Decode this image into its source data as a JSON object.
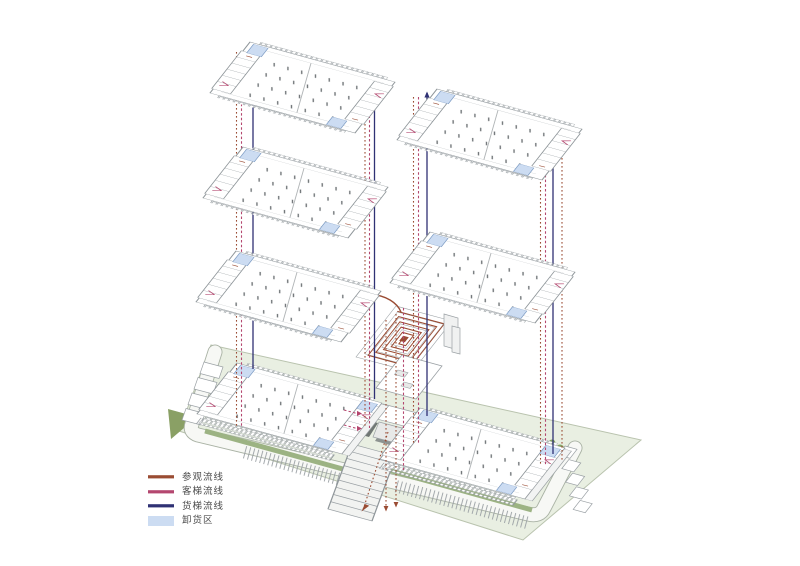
{
  "legend": {
    "items": [
      {
        "label": "参观流线",
        "color": "#9a4c33",
        "type": "line"
      },
      {
        "label": "客梯流线",
        "color": "#b4476f",
        "type": "line"
      },
      {
        "label": "货梯流线",
        "color": "#2f3174",
        "type": "line"
      },
      {
        "label": "卸货区",
        "color": "#ccdcf2",
        "type": "area"
      }
    ]
  },
  "colors": {
    "site_green": "#e9efe2",
    "site_edge": "#b9c3ae",
    "hedge_green": "#9cb383",
    "dark_green": "#8aa065",
    "road_fill": "#f7f8f5",
    "road_edge": "#a9b2a4",
    "plate_outline": "#8f969a",
    "paving_dark": "#707774"
  },
  "diagram": {
    "left_tower_plates": 3,
    "right_tower_plates": 2,
    "ground_buildings": 2,
    "has_spiral_core": true
  }
}
